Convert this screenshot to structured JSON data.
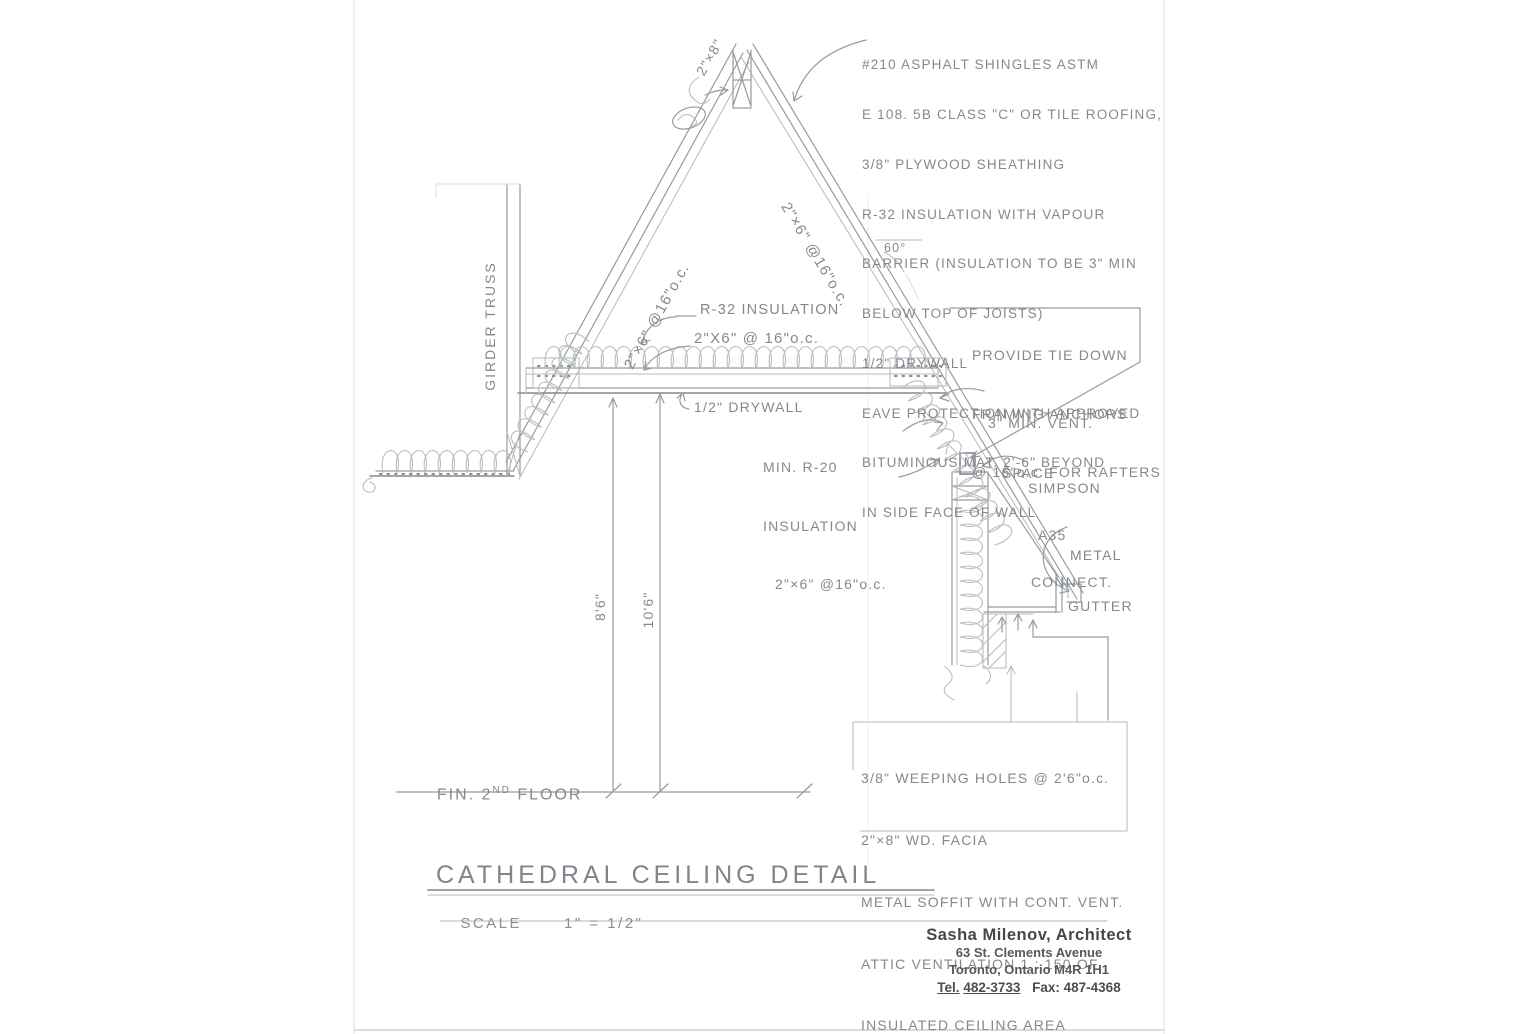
{
  "sheet": {
    "title": "CATHEDRAL CEILING DETAIL",
    "scale_label": "SCALE",
    "scale_value": "1\" = 1/2\""
  },
  "stamp": {
    "name": "Sasha Milenov, Architect",
    "address_line1": "63 St. Clements Avenue",
    "address_line2": "Toronto, Ontario  M4R 1H1",
    "tel_label": "Tel.",
    "tel_number": "482-3733",
    "fax": "Fax: 487-4368"
  },
  "roof_note": {
    "lines": [
      "#210 ASPHALT SHINGLES ASTM",
      "E 108. 5B CLASS \"C\" OR TILE ROOFING,",
      "3/8\" PLYWOOD SHEATHING",
      "R-32 INSULATION WITH VAPOUR",
      "BARRIER (INSULATION TO BE 3\" MIN",
      "BELOW TOP OF JOISTS)",
      "1/2\" DRYWALL",
      "EAVE PROTECTION WITH APPROVED",
      "BITUMINOUS MAT. 2'-6\" BEYOND",
      "IN SIDE FACE OF WALL"
    ]
  },
  "tie_down_note": {
    "lines": [
      "PROVIDE TIE DOWN",
      "FRAMING ANCHORS",
      "@ 16\"o.c. FOR RAFTERS"
    ]
  },
  "soffit_note": {
    "lines": [
      "3/8\" WEEPING HOLES @ 2'6\"o.c.",
      "2\"×8\" WD. FACIA",
      "METAL SOFFIT WITH CONT. VENT.",
      "ATTIC VENTILATION 1 : 150 OF",
      "INSULATED CEILING AREA"
    ]
  },
  "labels": {
    "ridge_size": "2\"×8\"",
    "left_rafter": "2\"×6\" @16\"o.c.",
    "right_rafter": "2\"×6\" @16\"o.c.",
    "ceiling_insulation": "R-32 INSULATION",
    "ceiling_joists": "2\"X6\" @ 16\"o.c.",
    "drywall": "1/2\" DRYWALL",
    "eave_insulation_line1": "MIN. R-20",
    "eave_insulation_line2": "INSULATION",
    "eave_insulation_line3": "2\"×6\" @16\"o.c.",
    "vent_line1": "3\" MIN. VENT.",
    "vent_line2": "SPACE",
    "connector_line1": "SIMPSON",
    "connector_line2": "A35",
    "connector_line3": "CONNECT.",
    "gutter_line1": "METAL",
    "gutter_line2": "GUTTER",
    "girder_truss": "GIRDER TRUSS",
    "roof_angle": "60°",
    "dim_ceiling_height": "8'6\"",
    "dim_peak_height": "10'6\"",
    "floor_prefix": "FIN. 2",
    "floor_sup": "ND",
    "floor_suffix": " FLOOR"
  },
  "colors": {
    "pencil": "#969b9f",
    "pencil_light": "#b9bec1",
    "stamp_ink": "#44474b"
  }
}
